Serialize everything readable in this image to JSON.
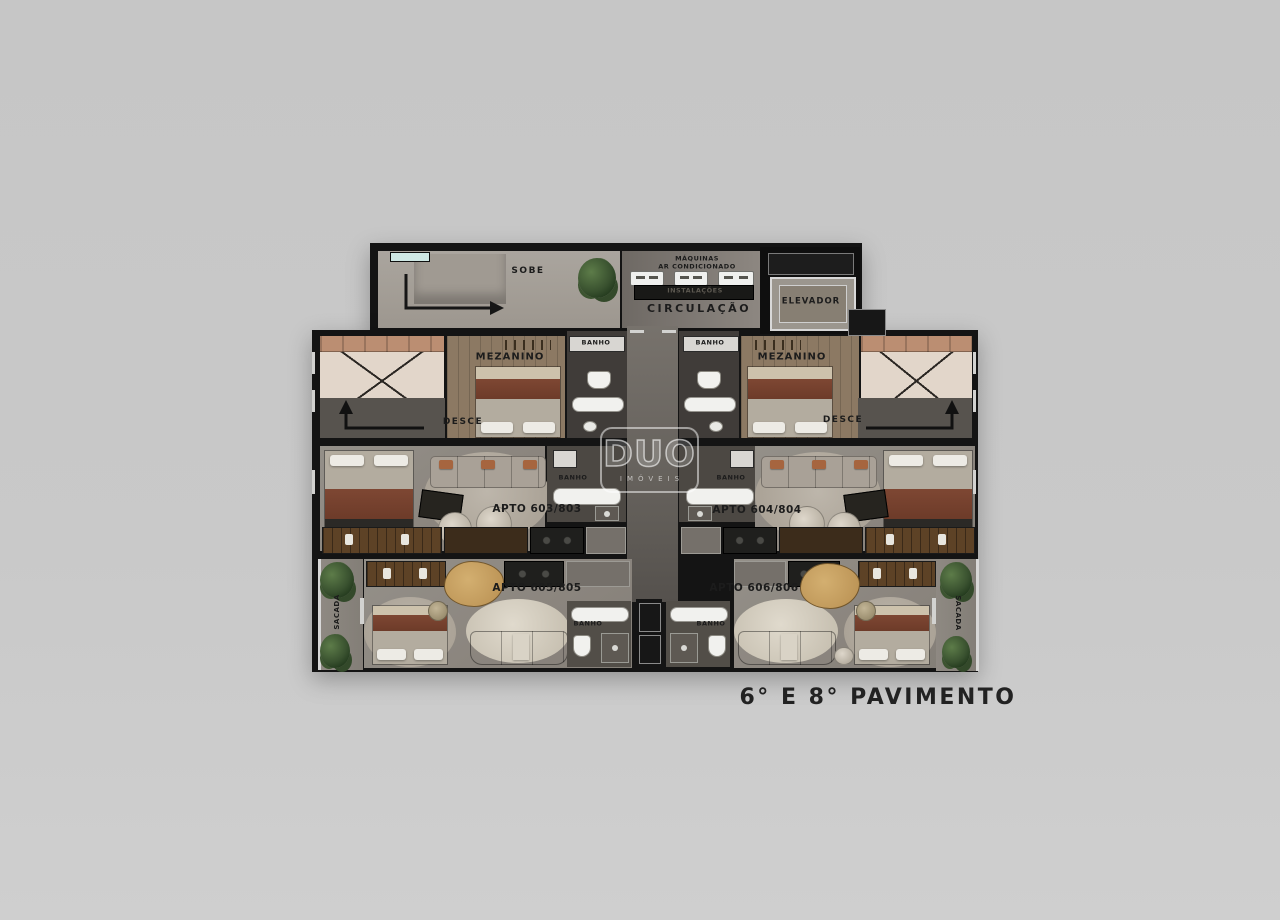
{
  "floor_title": "6° E 8° PAVIMENTO",
  "watermark": {
    "logo": "DUO",
    "subtitle": "IMÓVEIS"
  },
  "core": {
    "stairs_up": "SOBE",
    "machines_line1": "MÁQUINAS",
    "machines_line2": "AR CONDICIONADO",
    "installations": "INSTALAÇÕES",
    "circulation": "CIRCULAÇÃO",
    "elevator": "ELEVADOR"
  },
  "mezzanines": {
    "left": {
      "room": "MEZANINO",
      "stairs_down": "DESCE",
      "bath": "BANHO"
    },
    "right": {
      "room": "MEZANINO",
      "stairs_down": "DESCE",
      "bath": "BANHO"
    }
  },
  "apartments": {
    "apto_603": {
      "label": "APTO 603/803",
      "bath": "BANHO"
    },
    "apto_604": {
      "label": "APTO 604/804",
      "bath": "BANHO"
    },
    "apto_605": {
      "label": "APTO 605/805",
      "bath": "BANHO",
      "balcony": "SACADA"
    },
    "apto_606": {
      "label": "APTO 606/806",
      "bath": "BANHO",
      "balcony": "SACADA"
    }
  },
  "colors": {
    "background": "#c9c9c9",
    "walls": "#141414",
    "floor_light": "#a49f98",
    "floor_unit": "#8e8881",
    "floor_wood": "#8c7963",
    "bath_dark": "#403c39",
    "accent_teal": "#cfe8e4"
  }
}
